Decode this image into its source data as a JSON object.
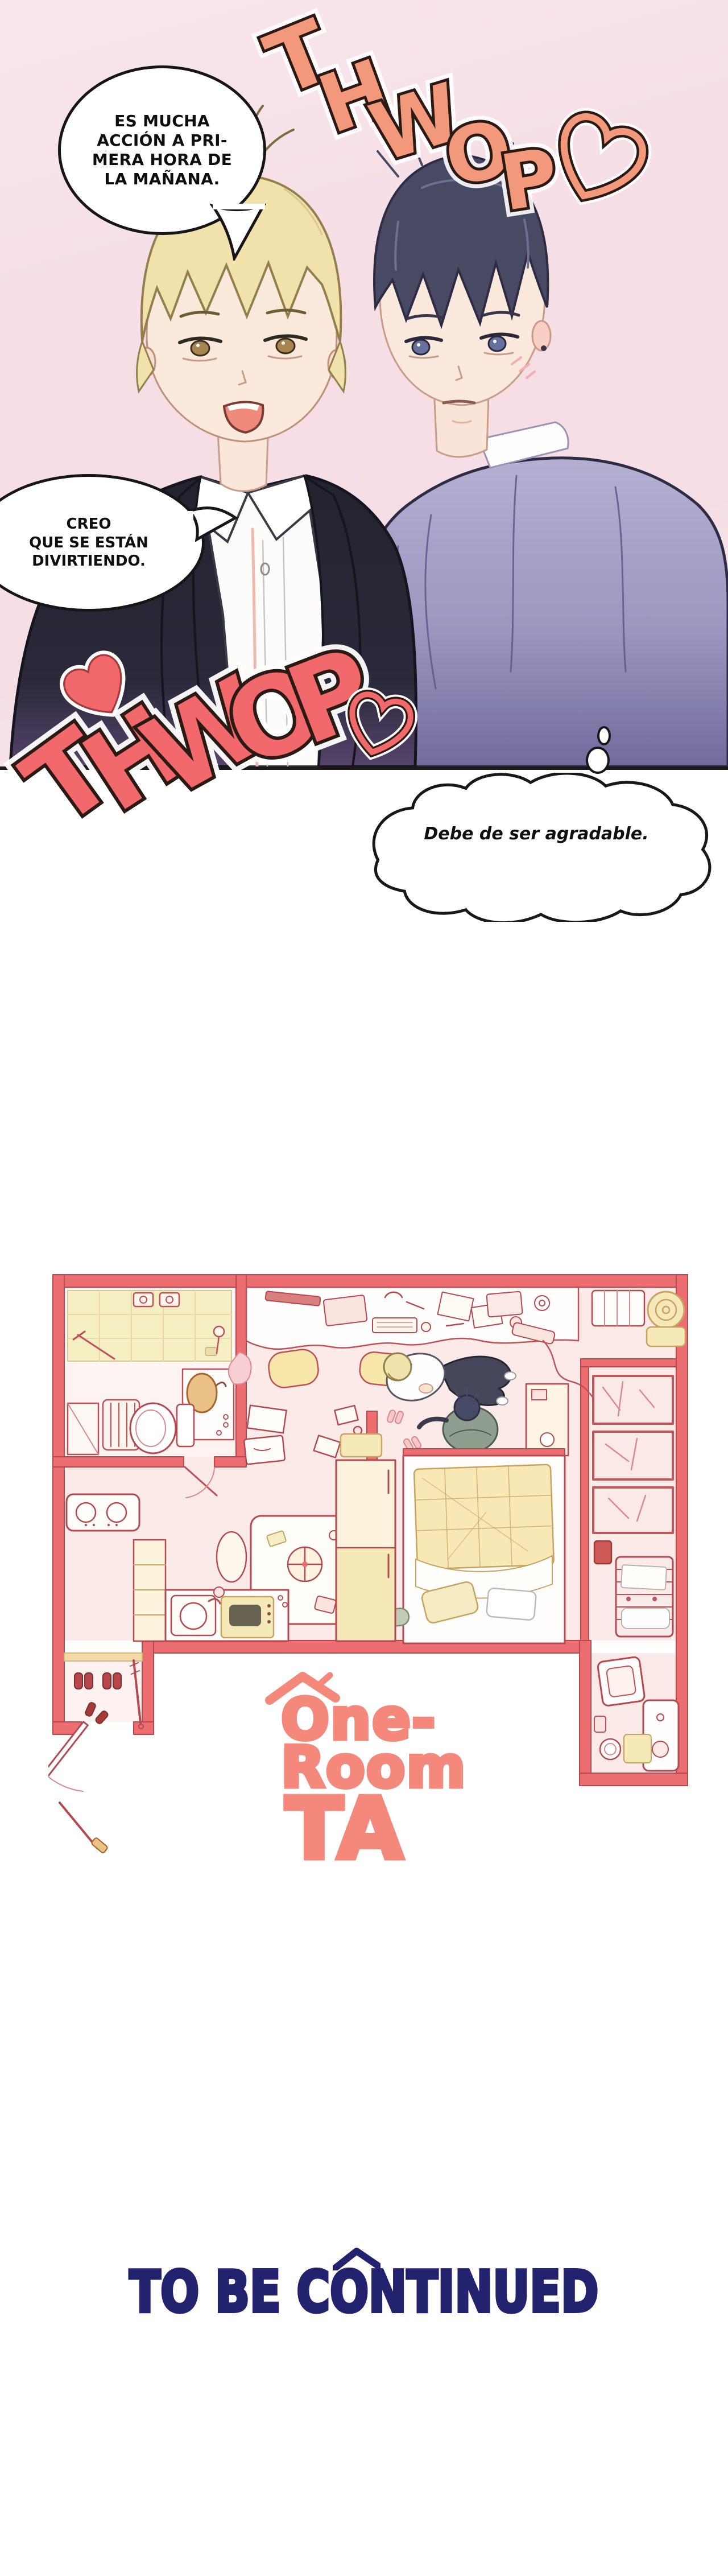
{
  "comic": {
    "bubble1": {
      "lines": [
        "ES MUCHA",
        "ACCIÓN A PRI-",
        "MERA HORA DE",
        "LA MAÑANA."
      ]
    },
    "bubble2": {
      "lines": [
        "CREO",
        "QUE SE ESTÁN",
        "DIVIRTIENDO."
      ]
    },
    "thought_bubble": {
      "text": "Debe de ser agradable."
    },
    "sfx_top": {
      "word": "THWOP",
      "letters": [
        "T",
        "H",
        "W",
        "O",
        "P"
      ]
    },
    "sfx_bottom": {
      "word": "THWOP",
      "letters": [
        "T",
        "H",
        "W",
        "O",
        "P"
      ]
    }
  },
  "floorplan_logo": {
    "line1": "One-",
    "line2": "Room",
    "line3": "TA"
  },
  "footer": {
    "text": "TO BE CONTINUED"
  },
  "colors": {
    "sfx_top": "#F2997C",
    "sfx_bottom": "#F2696C",
    "heart": "#F2696C",
    "logo": "#F4887B",
    "footer_text": "#23226E",
    "wall_red": "#EC6E71",
    "floor_pink": "#FBEAE8",
    "furniture_cream": "#FCF3DC",
    "accent_yellow": "#F6E9B8",
    "panel_bg_pink": "#F6DFE6"
  }
}
